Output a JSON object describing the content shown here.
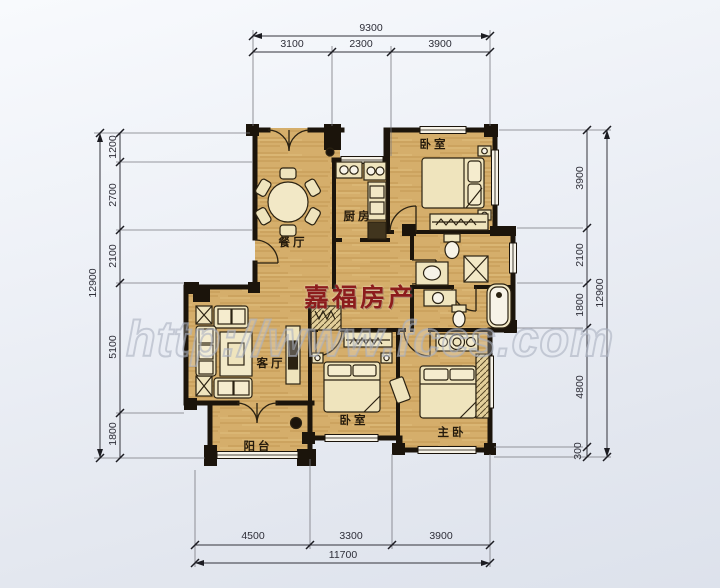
{
  "watermark": {
    "brand": "嘉福房产",
    "site": "http://www.fccs.com"
  },
  "rooms": {
    "dining": "餐厅",
    "kitchen": "厨房",
    "bedroom_top": "卧室",
    "living": "客厅",
    "bedroom_mid": "卧室",
    "master": "主卧",
    "balcony": "阳台"
  },
  "dimensions": {
    "top": {
      "total": "9300",
      "segments": [
        "3100",
        "2300",
        "3900"
      ]
    },
    "bottom": {
      "total": "11700",
      "segments": [
        "4500",
        "3300",
        "3900"
      ]
    },
    "left": {
      "total": "12900",
      "segments": [
        "1200",
        "2700",
        "2100",
        "5100",
        "1800"
      ]
    },
    "right": {
      "total": "12900",
      "segments": [
        "3900",
        "2100",
        "1800",
        "4800",
        "300"
      ]
    }
  },
  "colors": {
    "floor": "#d5ae6b",
    "wall": "#1b140b",
    "brand_red": "#8c1c1c",
    "dimension_text": "#2e2e38",
    "watermark_gray": "#aab1c0"
  }
}
